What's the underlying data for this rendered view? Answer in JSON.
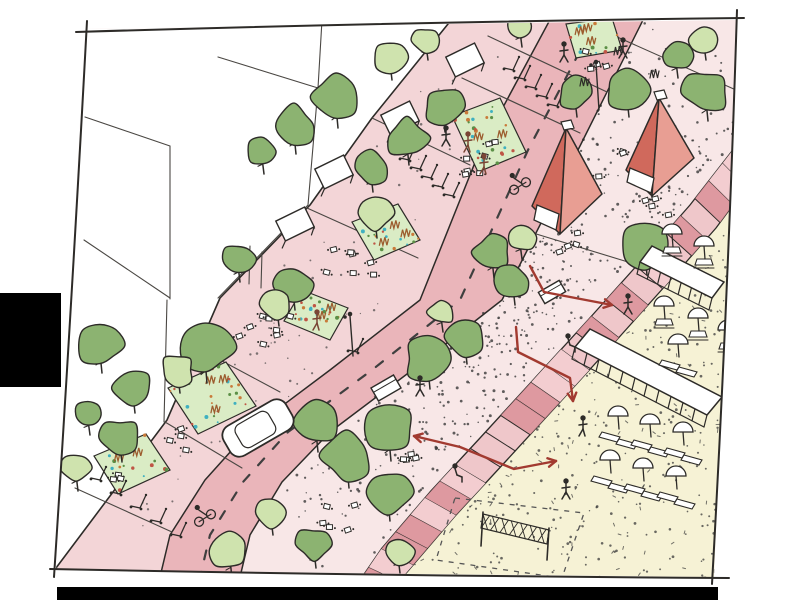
{
  "meta": {
    "description": "Hand-drawn urban design sketch: diagonal street with green trees, planting beds, red pavilion tents, stepped edge and yellow beach plaza with umbrellas; red pedestrian-flow arrows; black bars at left edge and bottom."
  },
  "palette": {
    "ink": "#2d2b28",
    "line_soft": "#4a4743",
    "sidewalk": "#f3d5d7",
    "road": "#eab5ba",
    "promenade": "#f8e7e7",
    "steps_base": "#efc7ca",
    "steps_dark": "#db949b",
    "steps_mid": "#f3cdd0",
    "beach": "#f6f2d5",
    "tree_dark": "#8cb371",
    "tree_light": "#cfe3ae",
    "bed_green": "#daecc5",
    "bed_teal": "#3fb0c0",
    "bed_orange": "#c97a3a",
    "bed_red": "#bf5545",
    "bed_leaf": "#5b8f46",
    "grass_brown": "#9c5c2e",
    "tent_dark": "#d0695c",
    "tent_light": "#e89e93",
    "arrow": "#a23a30",
    "white": "#ffffff",
    "stipple": "#3a3a3a",
    "figure_brown": "#7a4434",
    "black_bar": "#000000"
  },
  "frame": {
    "corners": [
      [
        85,
        29
      ],
      [
        737,
        20
      ],
      [
        714,
        577
      ],
      [
        56,
        570
      ]
    ],
    "strokes": {
      "top": [
        [
          76,
          32
        ],
        [
          400,
          22
        ],
        [
          744,
          18
        ]
      ],
      "right": [
        [
          737,
          10
        ],
        [
          728,
          300
        ],
        [
          712,
          584
        ]
      ],
      "bottom": [
        [
          50,
          569
        ],
        [
          390,
          576
        ],
        [
          729,
          578
        ]
      ],
      "left": [
        [
          87,
          21
        ],
        [
          72,
          300
        ],
        [
          54,
          577
        ]
      ]
    }
  },
  "bars": {
    "left": {
      "x": 0,
      "y": 293,
      "w": 61,
      "h": 94
    },
    "bottom": {
      "x": 57,
      "y": 587,
      "w": 661,
      "h": 13
    }
  },
  "zones": {
    "facade": [
      [
        448,
        24
      ],
      [
        372,
        118
      ],
      [
        310,
        205
      ],
      [
        220,
        298
      ],
      [
        167,
        420
      ],
      [
        56,
        568
      ]
    ],
    "buildings_poly": [
      [
        85,
        29
      ],
      [
        448,
        24
      ],
      [
        372,
        118
      ],
      [
        310,
        205
      ],
      [
        220,
        298
      ],
      [
        167,
        420
      ],
      [
        56,
        568
      ],
      [
        56,
        30
      ]
    ],
    "road_left": [
      [
        552,
        16
      ],
      [
        480,
        150
      ],
      [
        420,
        300
      ],
      [
        330,
        370
      ],
      [
        250,
        430
      ],
      [
        205,
        480
      ],
      [
        170,
        535
      ],
      [
        160,
        577
      ]
    ],
    "road_right": [
      [
        648,
        10
      ],
      [
        578,
        150
      ],
      [
        502,
        300
      ],
      [
        415,
        368
      ],
      [
        330,
        432
      ],
      [
        282,
        482
      ],
      [
        250,
        535
      ],
      [
        240,
        577
      ]
    ],
    "dash_center": [
      [
        600,
        13
      ],
      [
        528,
        150
      ],
      [
        460,
        300
      ],
      [
        372,
        370
      ],
      [
        288,
        432
      ],
      [
        243,
        482
      ],
      [
        210,
        535
      ],
      [
        200,
        577
      ]
    ],
    "steps_left": [
      [
        750,
        128
      ],
      [
        690,
        205
      ],
      [
        640,
        262
      ],
      [
        588,
        320
      ],
      [
        535,
        378
      ],
      [
        480,
        438
      ],
      [
        430,
        492
      ],
      [
        382,
        548
      ],
      [
        356,
        586
      ]
    ],
    "steps_right": [
      [
        772,
        152
      ],
      [
        716,
        228
      ],
      [
        666,
        285
      ],
      [
        614,
        343
      ],
      [
        561,
        401
      ],
      [
        506,
        461
      ],
      [
        456,
        515
      ],
      [
        408,
        571
      ],
      [
        384,
        598
      ]
    ],
    "yellow_poly": [
      [
        732,
        192
      ],
      [
        716,
        228
      ],
      [
        666,
        285
      ],
      [
        614,
        343
      ],
      [
        561,
        401
      ],
      [
        506,
        461
      ],
      [
        456,
        515
      ],
      [
        408,
        571
      ],
      [
        392,
        578
      ],
      [
        714,
        578
      ]
    ]
  },
  "building_lines": [
    [
      [
        85,
        117
      ],
      [
        170,
        146
      ]
    ],
    [
      [
        170,
        146
      ],
      [
        170,
        299
      ]
    ],
    [
      [
        218,
        57
      ],
      [
        318,
        88
      ]
    ],
    [
      [
        322,
        20
      ],
      [
        318,
        88
      ]
    ],
    [
      [
        318,
        88
      ],
      [
        308,
        205
      ]
    ],
    [
      [
        308,
        205
      ],
      [
        218,
        298
      ]
    ],
    [
      [
        84,
        240
      ],
      [
        170,
        298
      ]
    ],
    [
      [
        167,
        300
      ],
      [
        164,
        422
      ]
    ],
    [
      [
        250,
        246
      ],
      [
        249,
        284
      ]
    ],
    [
      [
        262,
        252
      ],
      [
        261,
        288
      ]
    ]
  ],
  "awning_frames": [
    {
      "x": 465,
      "y": 60,
      "a": -26
    },
    {
      "x": 400,
      "y": 118,
      "a": -26
    },
    {
      "x": 334,
      "y": 172,
      "a": -26
    },
    {
      "x": 295,
      "y": 224,
      "a": -26
    }
  ],
  "transverse_lines": [
    [
      [
        372,
        118
      ],
      [
        470,
        165
      ]
    ],
    [
      [
        307,
        208
      ],
      [
        418,
        258
      ]
    ],
    [
      [
        183,
        340
      ],
      [
        280,
        392
      ]
    ],
    [
      [
        165,
        422
      ],
      [
        242,
        468
      ]
    ],
    [
      [
        75,
        488
      ],
      [
        172,
        532
      ]
    ],
    [
      [
        615,
        36
      ],
      [
        736,
        90
      ]
    ],
    [
      [
        533,
        233
      ],
      [
        628,
        262
      ]
    ]
  ],
  "crossing_lines": [
    [
      [
        488,
        36
      ],
      [
        607,
        92
      ]
    ],
    [
      [
        462,
        78
      ],
      [
        580,
        133
      ]
    ]
  ],
  "beds": [
    {
      "quad": [
        [
          566,
          24
        ],
        [
          612,
          18
        ],
        [
          622,
          50
        ],
        [
          576,
          58
        ]
      ],
      "grasses": 3,
      "dots": 10
    },
    {
      "quad": [
        [
          452,
          116
        ],
        [
          500,
          98
        ],
        [
          526,
          152
        ],
        [
          478,
          172
        ]
      ],
      "grasses": 2,
      "dots": 26
    },
    {
      "quad": [
        [
          352,
          222
        ],
        [
          398,
          204
        ],
        [
          420,
          240
        ],
        [
          374,
          260
        ]
      ],
      "grasses": 3,
      "dots": 20
    },
    {
      "quad": [
        [
          302,
          290
        ],
        [
          348,
          308
        ],
        [
          330,
          340
        ],
        [
          284,
          321
        ]
      ],
      "grasses": 2,
      "dots": 22
    },
    {
      "quad": [
        [
          168,
          388
        ],
        [
          226,
          362
        ],
        [
          256,
          406
        ],
        [
          198,
          434
        ]
      ],
      "grasses": 3,
      "dots": 24
    },
    {
      "quad": [
        [
          94,
          456
        ],
        [
          146,
          434
        ],
        [
          170,
          470
        ],
        [
          118,
          494
        ]
      ],
      "grasses": 2,
      "dots": 16
    }
  ],
  "trees": [
    {
      "x": 390,
      "y": 57,
      "r": 16,
      "tone": "L"
    },
    {
      "x": 426,
      "y": 40,
      "r": 13,
      "tone": "L"
    },
    {
      "x": 520,
      "y": 26,
      "r": 14,
      "tone": "L"
    },
    {
      "x": 336,
      "y": 97,
      "r": 24,
      "tone": "D"
    },
    {
      "x": 294,
      "y": 126,
      "r": 21,
      "tone": "D"
    },
    {
      "x": 443,
      "y": 106,
      "r": 19,
      "tone": "D"
    },
    {
      "x": 407,
      "y": 138,
      "r": 20,
      "tone": "D"
    },
    {
      "x": 371,
      "y": 168,
      "r": 17,
      "tone": "D"
    },
    {
      "x": 262,
      "y": 152,
      "r": 15,
      "tone": "D"
    },
    {
      "x": 375,
      "y": 213,
      "r": 18,
      "tone": "L"
    },
    {
      "x": 293,
      "y": 284,
      "r": 19,
      "tone": "D"
    },
    {
      "x": 277,
      "y": 304,
      "r": 15,
      "tone": "L"
    },
    {
      "x": 238,
      "y": 259,
      "r": 16,
      "tone": "D"
    },
    {
      "x": 205,
      "y": 348,
      "r": 28,
      "tone": "D"
    },
    {
      "x": 178,
      "y": 370,
      "r": 16,
      "tone": "L"
    },
    {
      "x": 100,
      "y": 345,
      "r": 21,
      "tone": "D"
    },
    {
      "x": 133,
      "y": 388,
      "r": 18,
      "tone": "D"
    },
    {
      "x": 88,
      "y": 415,
      "r": 13,
      "tone": "D"
    },
    {
      "x": 120,
      "y": 437,
      "r": 18,
      "tone": "D"
    },
    {
      "x": 76,
      "y": 468,
      "r": 16,
      "tone": "L"
    },
    {
      "x": 676,
      "y": 56,
      "r": 15,
      "tone": "D"
    },
    {
      "x": 704,
      "y": 40,
      "r": 13,
      "tone": "L"
    },
    {
      "x": 627,
      "y": 90,
      "r": 20,
      "tone": "D"
    },
    {
      "x": 706,
      "y": 92,
      "r": 22,
      "tone": "D"
    },
    {
      "x": 575,
      "y": 93,
      "r": 17,
      "tone": "D"
    },
    {
      "x": 645,
      "y": 246,
      "r": 22,
      "tone": "D"
    },
    {
      "x": 492,
      "y": 252,
      "r": 19,
      "tone": "D"
    },
    {
      "x": 513,
      "y": 281,
      "r": 17,
      "tone": "D"
    },
    {
      "x": 520,
      "y": 238,
      "r": 14,
      "tone": "L"
    },
    {
      "x": 465,
      "y": 336,
      "r": 21,
      "tone": "D"
    },
    {
      "x": 428,
      "y": 359,
      "r": 23,
      "tone": "D"
    },
    {
      "x": 389,
      "y": 430,
      "r": 24,
      "tone": "D"
    },
    {
      "x": 347,
      "y": 456,
      "r": 25,
      "tone": "D"
    },
    {
      "x": 316,
      "y": 423,
      "r": 22,
      "tone": "D"
    },
    {
      "x": 271,
      "y": 512,
      "r": 16,
      "tone": "L"
    },
    {
      "x": 230,
      "y": 552,
      "r": 19,
      "tone": "L"
    },
    {
      "x": 314,
      "y": 544,
      "r": 17,
      "tone": "D"
    },
    {
      "x": 398,
      "y": 551,
      "r": 15,
      "tone": "L"
    },
    {
      "x": 441,
      "y": 312,
      "r": 13,
      "tone": "L"
    },
    {
      "x": 388,
      "y": 492,
      "r": 22,
      "tone": "D"
    }
  ],
  "tents": [
    {
      "apex": [
        566,
        128
      ],
      "baseL": [
        532,
        206
      ],
      "baseF": [
        560,
        234
      ],
      "baseR": [
        602,
        194
      ],
      "door": [
        [
          537,
          205
        ],
        [
          559,
          214
        ],
        [
          556,
          230
        ],
        [
          534,
          220
        ]
      ]
    },
    {
      "apex": [
        659,
        98
      ],
      "baseL": [
        626,
        170
      ],
      "baseF": [
        652,
        196
      ],
      "baseR": [
        694,
        158
      ],
      "door": [
        [
          630,
          168
        ],
        [
          654,
          178
        ],
        [
          651,
          193
        ],
        [
          627,
          182
        ]
      ]
    }
  ],
  "awning_structures": [
    {
      "roof": [
        [
          652,
          246
        ],
        [
          724,
          282
        ],
        [
          712,
          298
        ],
        [
          640,
          262
        ]
      ],
      "legs": 7,
      "leg_edge": [
        [
          640,
          262
        ],
        [
          712,
          298
        ]
      ]
    },
    {
      "roof": [
        [
          590,
          329
        ],
        [
          722,
          397
        ],
        [
          707,
          415
        ],
        [
          575,
          347
        ]
      ],
      "legs": 11,
      "leg_edge": [
        [
          575,
          347
        ],
        [
          707,
          415
        ]
      ]
    }
  ],
  "umbrella_sets": [
    {
      "x": 618,
      "y": 416,
      "kind": "lounger"
    },
    {
      "x": 650,
      "y": 424,
      "kind": "lounger"
    },
    {
      "x": 683,
      "y": 432,
      "kind": "lounger"
    },
    {
      "x": 610,
      "y": 460,
      "kind": "lounger"
    },
    {
      "x": 643,
      "y": 468,
      "kind": "lounger"
    },
    {
      "x": 676,
      "y": 476,
      "kind": "lounger"
    },
    {
      "x": 672,
      "y": 234,
      "kind": "table"
    },
    {
      "x": 704,
      "y": 246,
      "kind": "table"
    },
    {
      "x": 664,
      "y": 306,
      "kind": "table"
    },
    {
      "x": 698,
      "y": 318,
      "kind": "table"
    },
    {
      "x": 728,
      "y": 330,
      "kind": "table"
    },
    {
      "x": 678,
      "y": 344,
      "kind": "lounger"
    }
  ],
  "stalls": [
    {
      "x": 552,
      "y": 292,
      "w": 24,
      "h": 13,
      "a": -30
    },
    {
      "x": 386,
      "y": 388,
      "w": 26,
      "h": 15,
      "a": -30
    }
  ],
  "table_clusters": [
    {
      "cx": 478,
      "cy": 160,
      "n": 7,
      "s": 26
    },
    {
      "cx": 352,
      "cy": 262,
      "n": 7,
      "s": 26
    },
    {
      "cx": 265,
      "cy": 335,
      "n": 8,
      "s": 28
    },
    {
      "cx": 180,
      "cy": 438,
      "n": 4,
      "s": 18
    },
    {
      "cx": 112,
      "cy": 476,
      "n": 3,
      "s": 14
    },
    {
      "cx": 628,
      "cy": 172,
      "n": 8,
      "s": 30
    },
    {
      "cx": 652,
      "cy": 210,
      "n": 4,
      "s": 18
    },
    {
      "cx": 560,
      "cy": 243,
      "n": 4,
      "s": 18
    },
    {
      "cx": 410,
      "cy": 458,
      "n": 4,
      "s": 16
    },
    {
      "cx": 342,
      "cy": 518,
      "n": 5,
      "s": 20
    },
    {
      "cx": 600,
      "cy": 60,
      "n": 4,
      "s": 16
    }
  ],
  "scooter_rows": [
    {
      "x": 508,
      "y": 62,
      "n": 5,
      "dx": 11,
      "dy": 9
    },
    {
      "x": 404,
      "y": 152,
      "n": 5,
      "dx": 11,
      "dy": 9
    },
    {
      "x": 95,
      "y": 472,
      "n": 5,
      "dx": 20,
      "dy": 14
    },
    {
      "x": 352,
      "y": 344,
      "n": 1,
      "dx": 0,
      "dy": 0
    }
  ],
  "people": [
    {
      "x": 623,
      "y": 40,
      "pose": "walk",
      "tone": "ink"
    },
    {
      "x": 564,
      "y": 44,
      "pose": "walk",
      "tone": "ink"
    },
    {
      "x": 446,
      "y": 128,
      "pose": "walk",
      "tone": "ink"
    },
    {
      "x": 420,
      "y": 378,
      "pose": "walk",
      "tone": "ink"
    },
    {
      "x": 628,
      "y": 296,
      "pose": "walk",
      "tone": "ink"
    },
    {
      "x": 583,
      "y": 418,
      "pose": "stand",
      "tone": "ink"
    },
    {
      "x": 566,
      "y": 481,
      "pose": "walk",
      "tone": "ink"
    },
    {
      "x": 568,
      "y": 336,
      "pose": "sit",
      "tone": "ink"
    },
    {
      "x": 455,
      "y": 466,
      "pose": "sit",
      "tone": "ink"
    },
    {
      "x": 468,
      "y": 134,
      "pose": "stand",
      "tone": "brown"
    },
    {
      "x": 484,
      "y": 156,
      "pose": "stand",
      "tone": "brown"
    },
    {
      "x": 317,
      "y": 312,
      "pose": "stand",
      "tone": "brown"
    }
  ],
  "cyclists": [
    {
      "x": 520,
      "y": 186,
      "a": -32
    },
    {
      "x": 205,
      "y": 518,
      "a": -32
    }
  ],
  "car": {
    "x": 258,
    "y": 428,
    "a": -30,
    "w": 72,
    "h": 34
  },
  "lamps": [
    {
      "x": 596,
      "y": 64,
      "h": 46
    },
    {
      "x": 350,
      "y": 316,
      "h": 40
    }
  ],
  "grass_tufts": [
    {
      "x": 654,
      "y": 78
    },
    {
      "x": 584,
      "y": 86
    },
    {
      "x": 618,
      "y": 55
    }
  ],
  "volleyball": {
    "posts": [
      [
        [
          483,
          512
        ],
        [
          481,
          546
        ]
      ],
      [
        [
          549,
          528
        ],
        [
          547,
          560
        ]
      ]
    ],
    "net": [
      [
        483,
        514
      ],
      [
        549,
        530
      ],
      [
        547,
        544
      ],
      [
        481,
        528
      ]
    ],
    "court": [
      [
        455,
        498
      ],
      [
        584,
        513
      ],
      [
        562,
        578
      ],
      [
        436,
        560
      ]
    ]
  },
  "arrows": [
    {
      "pts": [
        [
          530,
          266
        ],
        [
          544,
          292
        ],
        [
          612,
          305
        ]
      ],
      "heads": "end"
    },
    {
      "pts": [
        [
          516,
          327
        ],
        [
          518,
          352
        ],
        [
          570,
          378
        ],
        [
          573,
          401
        ]
      ],
      "heads": "end"
    },
    {
      "pts": [
        [
          556,
          461
        ],
        [
          514,
          469
        ],
        [
          460,
          447
        ],
        [
          414,
          436
        ]
      ],
      "heads": "both"
    }
  ],
  "stipple": {
    "promenade_dots": 480,
    "sidewalk_dots": 90,
    "beach_dots": 240,
    "beach_dashes": 80
  }
}
